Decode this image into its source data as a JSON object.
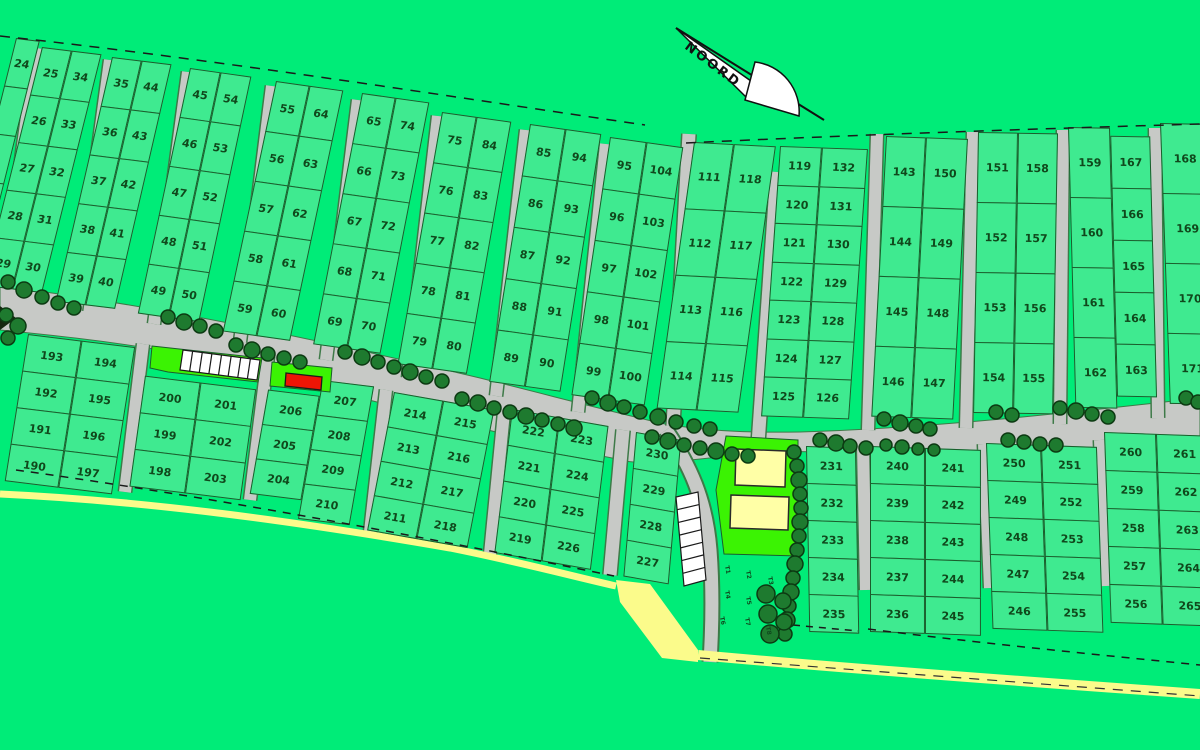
{
  "map": {
    "north_label": "NOORD",
    "t_labels": [
      "T1",
      "T2",
      "T3",
      "T4",
      "T5",
      "T6",
      "T7",
      "T8"
    ],
    "colors": {
      "background": "#00EC78",
      "plot_fill": "#3FEA90",
      "plot_border": "#1B5D2C",
      "number_text": "#10481C",
      "road_fill": "#C7C9C6",
      "road_edge": "#3E7A48",
      "tree_fill": "#1E7A2F",
      "tree_edge": "#0C3A12",
      "highlight_lime": "#3BF303",
      "building_yellow": "#FFFFA6",
      "beach_yellow": "#FBFB8B",
      "marker_red": "#EE1505",
      "dash_line": "#1A1A1A",
      "parking_white": "#FFFFFF"
    },
    "blocks": [
      {
        "id": "p0",
        "x": 16,
        "y": 38,
        "ax": 7,
        "ay": 14,
        "cols": [
          {
            "x": 0,
            "top": 0,
            "w": 24,
            "rowH": 49,
            "labels": [
              "24",
              "",
              "",
              "",
              ""
            ]
          }
        ]
      },
      {
        "id": "p1",
        "x": 42,
        "y": 47,
        "ax": 7,
        "ay": 14,
        "cols": [
          {
            "x": 0,
            "top": 0,
            "w": 30,
            "rowH": 49,
            "labels": [
              "25",
              "26",
              "27",
              "28",
              "29"
            ]
          },
          {
            "x": 30,
            "top": 0,
            "w": 30,
            "rowH": 49,
            "labels": [
              "34",
              "33",
              "32",
              "31",
              "30"
            ]
          }
        ]
      },
      {
        "id": "p2",
        "x": 112,
        "y": 57,
        "ax": 7,
        "ay": 13,
        "cols": [
          {
            "x": 0,
            "top": 0,
            "w": 30,
            "rowH": 50,
            "labels": [
              "35",
              "36",
              "37",
              "38",
              "39"
            ]
          },
          {
            "x": 30,
            "top": 0,
            "w": 30,
            "rowH": 50,
            "labels": [
              "44",
              "43",
              "42",
              "41",
              "40"
            ]
          }
        ]
      },
      {
        "id": "p3",
        "x": 190,
        "y": 68,
        "ax": 8,
        "ay": 12,
        "cols": [
          {
            "x": 0,
            "top": 0,
            "w": 31,
            "rowH": 50,
            "labels": [
              "45",
              "46",
              "47",
              "48",
              "49"
            ]
          },
          {
            "x": 31,
            "top": 0,
            "w": 31,
            "rowH": 50,
            "labels": [
              "54",
              "53",
              "52",
              "51",
              "50"
            ]
          }
        ]
      },
      {
        "id": "p4",
        "x": 276,
        "y": 81,
        "ax": 8,
        "ay": 12,
        "cols": [
          {
            "x": 0,
            "top": 0,
            "w": 34,
            "rowH": 51,
            "labels": [
              "55",
              "56",
              "57",
              "58",
              "59"
            ]
          },
          {
            "x": 34,
            "top": 0,
            "w": 34,
            "rowH": 51,
            "labels": [
              "64",
              "63",
              "62",
              "61",
              "60"
            ]
          }
        ]
      },
      {
        "id": "p5",
        "x": 362,
        "y": 93,
        "ax": 8,
        "ay": 11,
        "cols": [
          {
            "x": 0,
            "top": 0,
            "w": 34,
            "rowH": 51,
            "labels": [
              "65",
              "66",
              "67",
              "68",
              "69"
            ]
          },
          {
            "x": 34,
            "top": 0,
            "w": 34,
            "rowH": 51,
            "labels": [
              "74",
              "73",
              "72",
              "71",
              "70"
            ]
          }
        ]
      },
      {
        "id": "p6",
        "x": 442,
        "y": 112,
        "ax": 8,
        "ay": 10,
        "cols": [
          {
            "x": 0,
            "top": 0,
            "w": 35,
            "rowH": 51,
            "labels": [
              "75",
              "76",
              "77",
              "78",
              "79"
            ]
          },
          {
            "x": 35,
            "top": 0,
            "w": 35,
            "rowH": 51,
            "labels": [
              "84",
              "83",
              "82",
              "81",
              "80"
            ]
          }
        ]
      },
      {
        "id": "p7",
        "x": 530,
        "y": 124,
        "ax": 8,
        "ay": 9,
        "cols": [
          {
            "x": 0,
            "top": 0,
            "w": 36,
            "rowH": 52,
            "labels": [
              "85",
              "86",
              "87",
              "88",
              "89"
            ]
          },
          {
            "x": 36,
            "top": 0,
            "w": 36,
            "rowH": 52,
            "labels": [
              "94",
              "93",
              "92",
              "91",
              "90"
            ]
          }
        ]
      },
      {
        "id": "p8",
        "x": 610,
        "y": 137,
        "ax": 8,
        "ay": 8.5,
        "cols": [
          {
            "x": 0,
            "top": 0,
            "w": 37,
            "rowH": 52,
            "labels": [
              "95",
              "96",
              "97",
              "98",
              "99"
            ]
          },
          {
            "x": 37,
            "top": 0,
            "w": 37,
            "rowH": 52,
            "labels": [
              "104",
              "103",
              "102",
              "101",
              "100"
            ]
          }
        ]
      },
      {
        "id": "p9",
        "x": 694,
        "y": 142,
        "ax": 3,
        "ay": 8,
        "cols": [
          {
            "x": 0,
            "top": 0,
            "w": 40,
            "rowH": 67,
            "labels": [
              "111",
              "112",
              "113",
              "114"
            ]
          },
          {
            "x": 40,
            "top": 0,
            "w": 42,
            "rowH": 67,
            "labels": [
              "118",
              "117",
              "116",
              "115"
            ]
          }
        ]
      },
      {
        "id": "p10",
        "x": 780,
        "y": 146,
        "ax": 2,
        "ay": 4,
        "cols": [
          {
            "x": 0,
            "top": 0,
            "w": 42,
            "rowH": 38.5,
            "labels": [
              "119",
              "120",
              "121",
              "122",
              "123",
              "124",
              "125"
            ]
          },
          {
            "x": 42,
            "top": 0,
            "w": 46,
            "rowH": 38.5,
            "labels": [
              "132",
              "131",
              "130",
              "129",
              "128",
              "127",
              "126"
            ]
          }
        ]
      },
      {
        "id": "p11",
        "x": 886,
        "y": 136,
        "ax": 2,
        "ay": 3,
        "cols": [
          {
            "x": 0,
            "top": 0,
            "w": 40,
            "rowH": 70,
            "labels": [
              "143",
              "144",
              "145",
              "146"
            ]
          },
          {
            "x": 40,
            "top": 0,
            "w": 42,
            "rowH": 70,
            "labels": [
              "150",
              "149",
              "148",
              "147"
            ]
          }
        ]
      },
      {
        "id": "p12",
        "x": 978,
        "y": 132,
        "ax": 1,
        "ay": 1,
        "cols": [
          {
            "x": 0,
            "top": 0,
            "w": 40,
            "rowH": 70,
            "labels": [
              "151",
              "152",
              "153",
              "154"
            ]
          },
          {
            "x": 40,
            "top": 0,
            "w": 40,
            "rowH": 70,
            "labels": [
              "158",
              "157",
              "156",
              "155"
            ]
          }
        ]
      },
      {
        "id": "p13",
        "x": 1068,
        "y": 127,
        "ax": 1,
        "ay": -1.5,
        "cols": [
          {
            "x": 0,
            "top": 0,
            "w": 42,
            "rowH": 70,
            "labels": [
              "159",
              "160",
              "161",
              "162"
            ]
          },
          {
            "x": 42,
            "top": 8,
            "w": 40,
            "rowH": 52,
            "labels": [
              "167",
              "166",
              "165",
              "164",
              "163"
            ]
          }
        ]
      },
      {
        "id": "p14",
        "x": 1160,
        "y": 123,
        "ax": 1,
        "ay": -2,
        "cols": [
          {
            "x": 0,
            "top": 0,
            "w": 48,
            "rowH": 70,
            "labels": [
              "168",
              "169",
              "170",
              "171"
            ]
          }
        ]
      },
      {
        "id": "L1",
        "x": 28,
        "y": 334,
        "ax": 7,
        "ay": 9,
        "cols": [
          {
            "x": 0,
            "top": 0,
            "w": 54,
            "rowH": 37,
            "labels": [
              "193",
              "192",
              "191",
              "190"
            ]
          },
          {
            "x": 54,
            "top": 0,
            "w": 54,
            "rowH": 37,
            "labels": [
              "194",
              "195",
              "196",
              "197"
            ]
          }
        ]
      },
      {
        "id": "L2",
        "x": 150,
        "y": 340,
        "ax": 7,
        "ay": 8,
        "cols": [
          {
            "x": 0,
            "top": 36,
            "w": 56,
            "rowH": 37,
            "labels": [
              "200",
              "199",
              "198"
            ]
          },
          {
            "x": 56,
            "top": 36,
            "w": 56,
            "rowH": 37,
            "labels": [
              "201",
              "202",
              "203"
            ]
          }
        ]
      },
      {
        "id": "L3",
        "x": 274,
        "y": 356,
        "ax": 7,
        "ay": 10,
        "cols": [
          {
            "x": 0,
            "top": 34,
            "w": 52,
            "rowH": 35,
            "labels": [
              "206",
              "205",
              "204"
            ]
          },
          {
            "x": 52,
            "top": 18,
            "w": 52,
            "rowH": 35,
            "labels": [
              "207",
              "208",
              "209",
              "210"
            ]
          }
        ]
      },
      {
        "id": "M1",
        "x": 394,
        "y": 392,
        "ax": 10,
        "ay": 11,
        "cols": [
          {
            "x": 0,
            "top": 0,
            "w": 50,
            "rowH": 35,
            "labels": [
              "214",
              "213",
              "212",
              "211"
            ]
          },
          {
            "x": 50,
            "top": 0,
            "w": 52,
            "rowH": 35,
            "labels": [
              "215",
              "216",
              "217",
              "218"
            ]
          }
        ]
      },
      {
        "id": "M2",
        "x": 512,
        "y": 409,
        "ax": 10,
        "ay": 7,
        "cols": [
          {
            "x": 0,
            "top": 0,
            "w": 48,
            "rowH": 36,
            "labels": [
              "222",
              "221",
              "220",
              "219"
            ]
          },
          {
            "x": 48,
            "top": 0,
            "w": 50,
            "rowH": 36,
            "labels": [
              "223",
              "224",
              "225",
              "226"
            ]
          }
        ]
      },
      {
        "id": "M3",
        "x": 636,
        "y": 432,
        "ax": 10,
        "ay": 5,
        "cols": [
          {
            "x": 0,
            "top": 0,
            "w": 46,
            "rowH": 36,
            "labels": [
              "230",
              "229",
              "228",
              "227"
            ]
          }
        ]
      },
      {
        "id": "R1",
        "x": 806,
        "y": 446,
        "ax": 2,
        "ay": -1,
        "cols": [
          {
            "x": 0,
            "top": 0,
            "w": 50,
            "rowH": 37,
            "labels": [
              "231",
              "232",
              "233",
              "234",
              "235"
            ]
          }
        ]
      },
      {
        "id": "R2",
        "x": 870,
        "y": 446,
        "ax": 2,
        "ay": 0,
        "cols": [
          {
            "x": 0,
            "top": 0,
            "w": 55,
            "rowH": 37,
            "labels": [
              "240",
              "239",
              "238",
              "237",
              "236"
            ]
          },
          {
            "x": 55,
            "top": 0,
            "w": 56,
            "rowH": 37,
            "labels": [
              "241",
              "242",
              "243",
              "244",
              "245"
            ]
          }
        ]
      },
      {
        "id": "R3",
        "x": 986,
        "y": 443,
        "ax": 2,
        "ay": -2,
        "cols": [
          {
            "x": 0,
            "top": 0,
            "w": 55,
            "rowH": 37,
            "labels": [
              "250",
              "249",
              "248",
              "247",
              "246"
            ]
          },
          {
            "x": 55,
            "top": 0,
            "w": 56,
            "rowH": 37,
            "labels": [
              "251",
              "252",
              "253",
              "254",
              "255"
            ]
          }
        ]
      },
      {
        "id": "R4",
        "x": 1104,
        "y": 432,
        "ax": 2,
        "ay": -2,
        "cols": [
          {
            "x": 0,
            "top": 0,
            "w": 52,
            "rowH": 38,
            "labels": [
              "260",
              "259",
              "258",
              "257",
              "256"
            ]
          },
          {
            "x": 52,
            "top": 0,
            "w": 56,
            "rowH": 38,
            "labels": [
              "261",
              "262",
              "263",
              "264",
              "265"
            ]
          }
        ]
      }
    ]
  }
}
